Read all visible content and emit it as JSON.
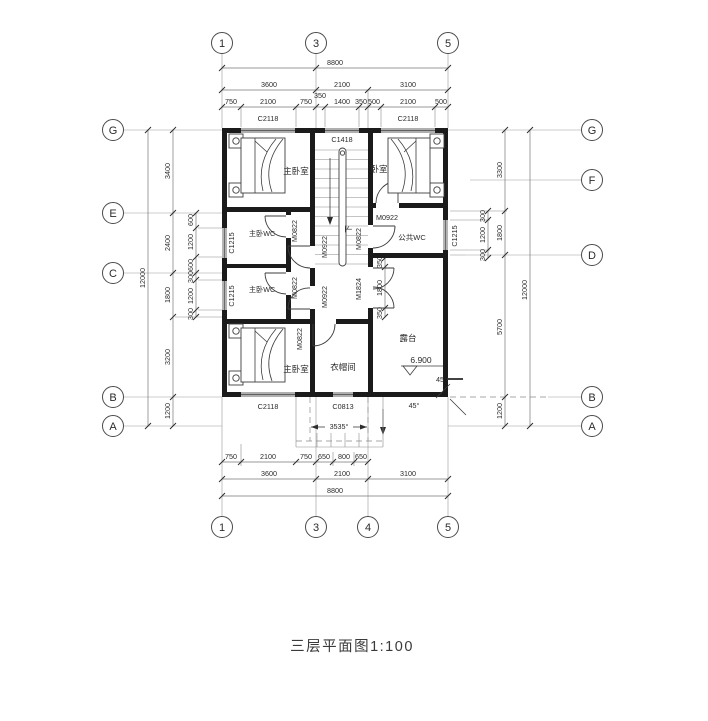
{
  "caption": "三层平面图1:100",
  "colors": {
    "paper": "#ffffff",
    "ink": "#1b1b1b"
  },
  "grid_bubbles": {
    "top": [
      "1",
      "3",
      "5"
    ],
    "bottom": [
      "1",
      "3",
      "4",
      "5"
    ],
    "left": [
      "G",
      "E",
      "C",
      "B",
      "A"
    ],
    "right": [
      "G",
      "F",
      "D",
      "B",
      "A"
    ]
  },
  "dims": {
    "top_total": "8800",
    "top_major": [
      "3600",
      "2100",
      "3100"
    ],
    "top_minor": [
      "750",
      "2100",
      "750",
      "350",
      "1400",
      "350",
      "500",
      "2100",
      "500"
    ],
    "bottom_total": "8800",
    "bottom_major": [
      "3600",
      "2100",
      "3100"
    ],
    "bottom_minor": [
      "750",
      "2100",
      "750",
      "650",
      "800",
      "650"
    ],
    "left_total": "12000",
    "left_major": [
      "3400",
      "2400",
      "1800",
      "3200",
      "1200"
    ],
    "left_minor": [
      "600",
      "1200",
      "600",
      "300",
      "1200",
      "300"
    ],
    "right_total": "12000",
    "right_major": [
      "3300",
      "1800",
      "5700",
      "1200"
    ],
    "right_minor": [
      "300",
      "1200",
      "300"
    ],
    "terrace_door": [
      "350",
      "1800",
      "350"
    ]
  },
  "windows": {
    "c2118": "C2118",
    "c1418": "C1418",
    "c1215": "C1215",
    "c0813": "C0813"
  },
  "doors": {
    "m0922": "M0922",
    "m0822": "M0822",
    "m1824": "M1824"
  },
  "rooms": {
    "master_bedroom_top": "主卧室",
    "bedroom": "卧室",
    "master_wc_1": "主卧WC",
    "master_wc_2": "主卧WC",
    "public_wc": "公共WC",
    "master_bedroom_bottom": "主卧室",
    "cloakroom": "衣帽间",
    "terrace": "露台"
  },
  "annotations": {
    "elevation": "6.900",
    "stair_down": "下",
    "angle_right": "45",
    "angle_bottom": "45°",
    "porch_span": "3535°"
  }
}
